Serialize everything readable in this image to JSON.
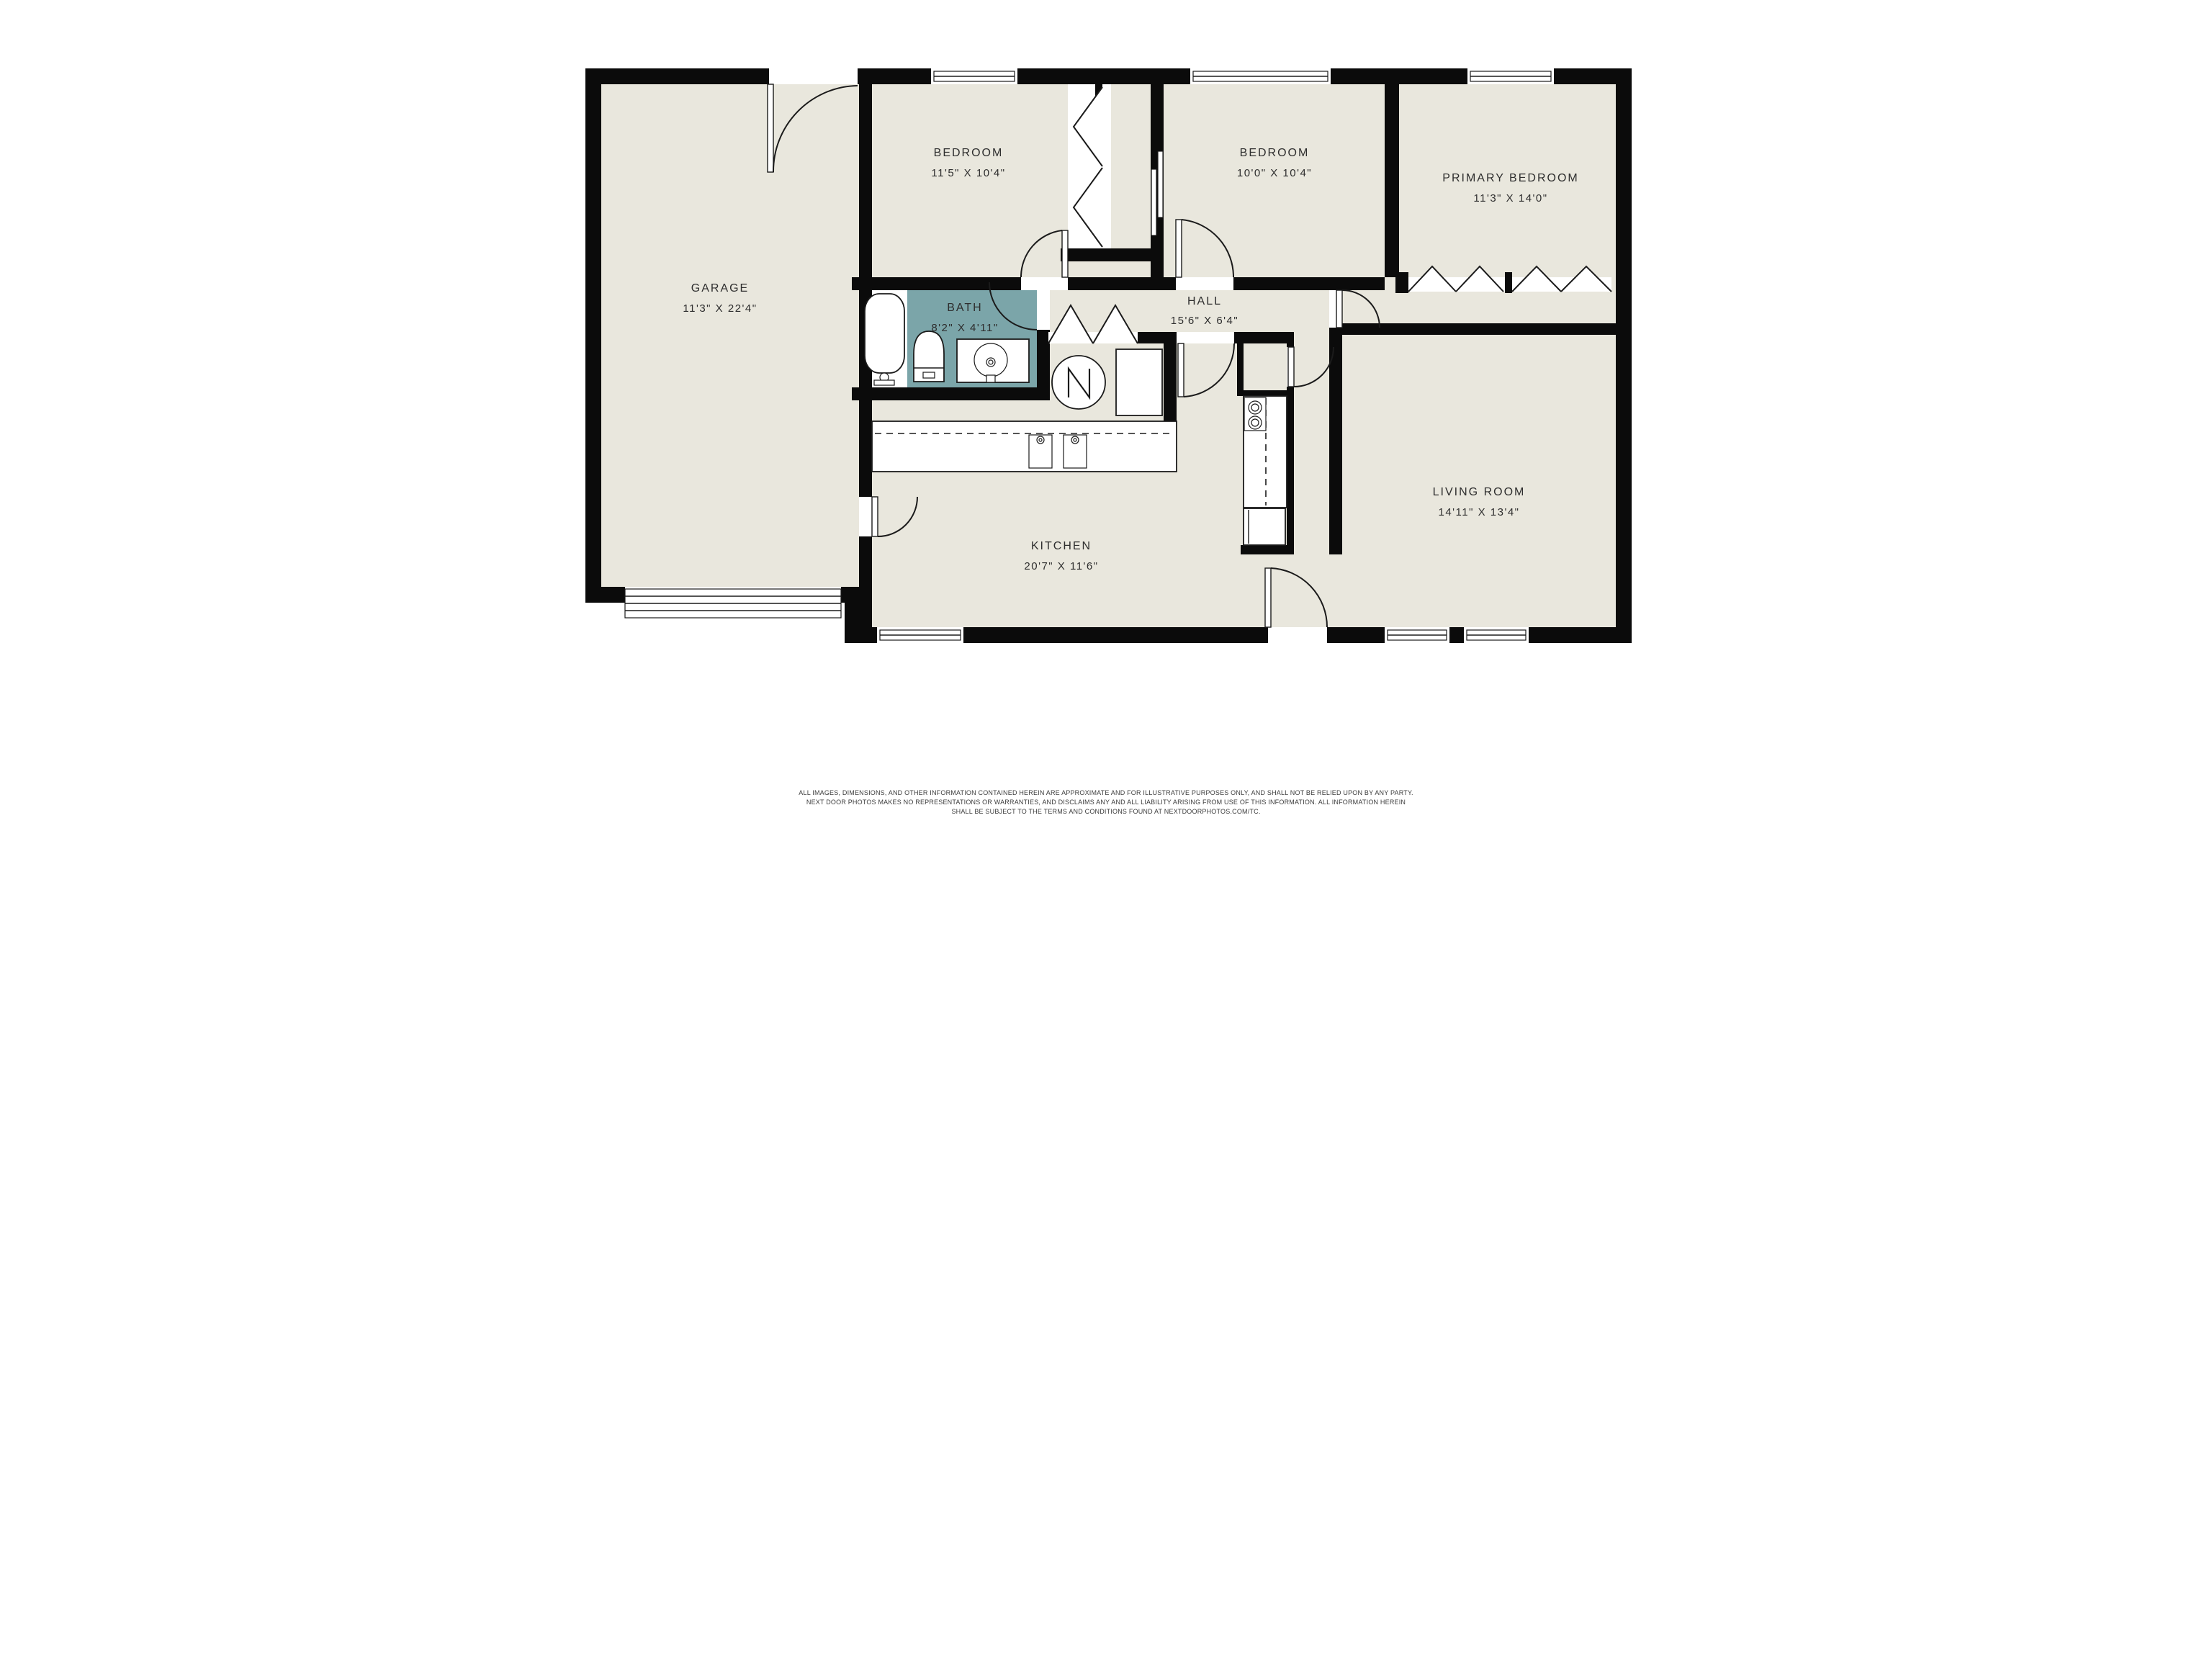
{
  "colors": {
    "wall": "#0b0b0b",
    "floor": "#e9e7dd",
    "bath": "#7ba5a9",
    "line": "#1b1b1b",
    "label": "#2e2e2e",
    "white": "#ffffff",
    "page": "#ffffff"
  },
  "rooms": {
    "garage": {
      "label": "GARAGE",
      "dims": "11'3\" X 22'4\""
    },
    "bedroom1": {
      "label": "BEDROOM",
      "dims": "11'5\" X 10'4\""
    },
    "bedroom2": {
      "label": "BEDROOM",
      "dims": "10'0\" X 10'4\""
    },
    "primary": {
      "label": "PRIMARY BEDROOM",
      "dims": "11'3\" X 14'0\""
    },
    "bath": {
      "label": "BATH",
      "dims": "8'2\" X 4'11\""
    },
    "hall": {
      "label": "HALL",
      "dims": "15'6\" X 6'4\""
    },
    "kitchen": {
      "label": "KITCHEN",
      "dims": "20'7\" X 11'6\""
    },
    "living": {
      "label": "LIVING ROOM",
      "dims": "14'11\" X 13'4\""
    }
  },
  "fixtures": [
    "bathtub",
    "toilet",
    "vanity-sink",
    "water-heater",
    "washer-dryer",
    "kitchen-counter",
    "double-sink",
    "range",
    "refrigerator",
    "pantry",
    "garage-door",
    "closet-bifold",
    "wardrobe",
    "pocket-door"
  ],
  "disclaimer": {
    "line1": "ALL IMAGES, DIMENSIONS, AND OTHER INFORMATION CONTAINED HEREIN ARE APPROXIMATE AND FOR ILLUSTRATIVE PURPOSES ONLY, AND SHALL NOT BE RELIED UPON BY ANY PARTY.",
    "line2": "NEXT DOOR PHOTOS MAKES NO REPRESENTATIONS OR WARRANTIES, AND DISCLAIMS ANY AND ALL LIABILITY ARISING FROM USE OF THIS INFORMATION. ALL INFORMATION HEREIN",
    "line3": "SHALL BE SUBJECT TO THE TERMS AND CONDITIONS FOUND AT NEXTDOORPHOTOS.COM/TC."
  }
}
